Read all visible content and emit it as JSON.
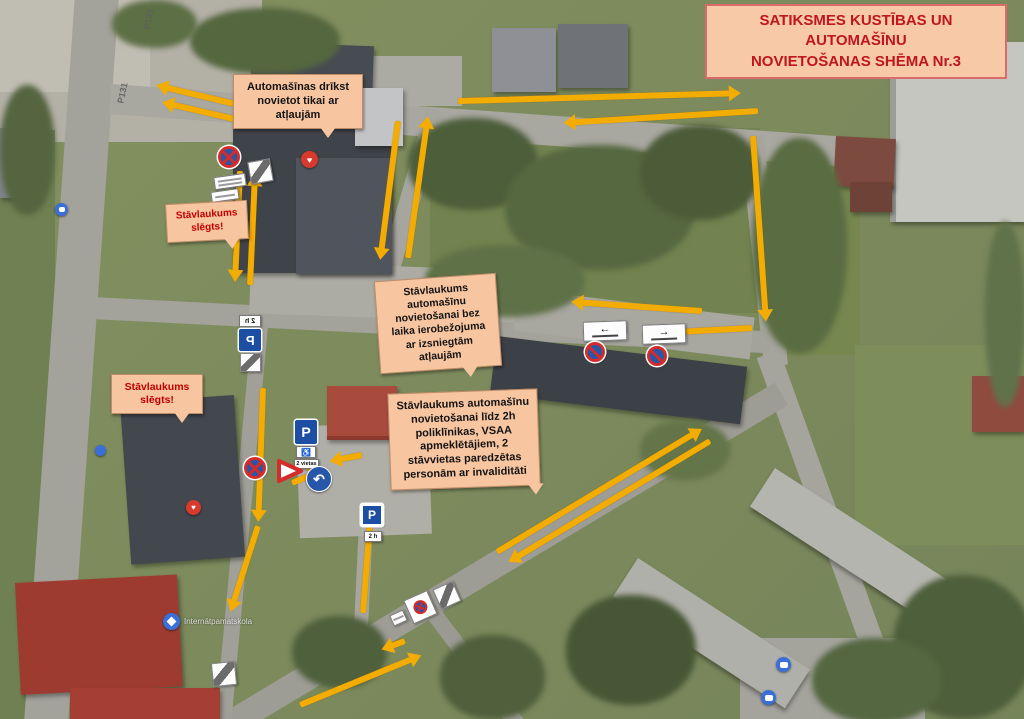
{
  "title": {
    "line1": "SATIKSMES KUSTĪBAS UN AUTOMAŠĪNU",
    "line2": "NOVIETOŠANAS SHĒMA Nr.3"
  },
  "callouts": [
    {
      "id": "permit-only",
      "text": "Automašīnas drīkst novietot tikai ar atļaujām"
    },
    {
      "id": "lot-closed-upper",
      "text": "Stāvlaukums slēgts!"
    },
    {
      "id": "lot-closed-lower",
      "text": "Stāvlaukums slēgts!"
    },
    {
      "id": "lot-no-time-limit",
      "text": "Stāvlaukums automašīnu novietošanai bez laika ierobežojuma ar izsniegtām atļaujām"
    },
    {
      "id": "lot-2h",
      "text": "Stāvlaukums automašīnu novietošanai līdz 2h poliklīnikas, VSAA apmeklētājiem, 2 stāvvietas paredzētas personām ar invaliditāti"
    }
  ],
  "signs": {
    "parking_letter": "P",
    "time_plate": "2 h",
    "spaces_plate": "2 vietas",
    "arrow_left": "←",
    "arrow_right": "→",
    "turn_arrow": "↶"
  },
  "icons": {
    "heart": "♥",
    "wheelchair": "♿"
  },
  "map": {
    "road_shield": "P131",
    "school_label": "Internātpamatskola"
  },
  "colors": {
    "arrow": "#F3AC01",
    "callout_bg": "#F7C5A0",
    "title_bg": "#F8C9A6",
    "title_text": "#BE1622",
    "title_border": "#DB6B6B",
    "closed_text": "#C00000",
    "sign_blue": "#2757A8",
    "sign_red": "#D42B2B",
    "poi_red": "#D83A2E",
    "poi_blue": "#3A6FD8"
  }
}
